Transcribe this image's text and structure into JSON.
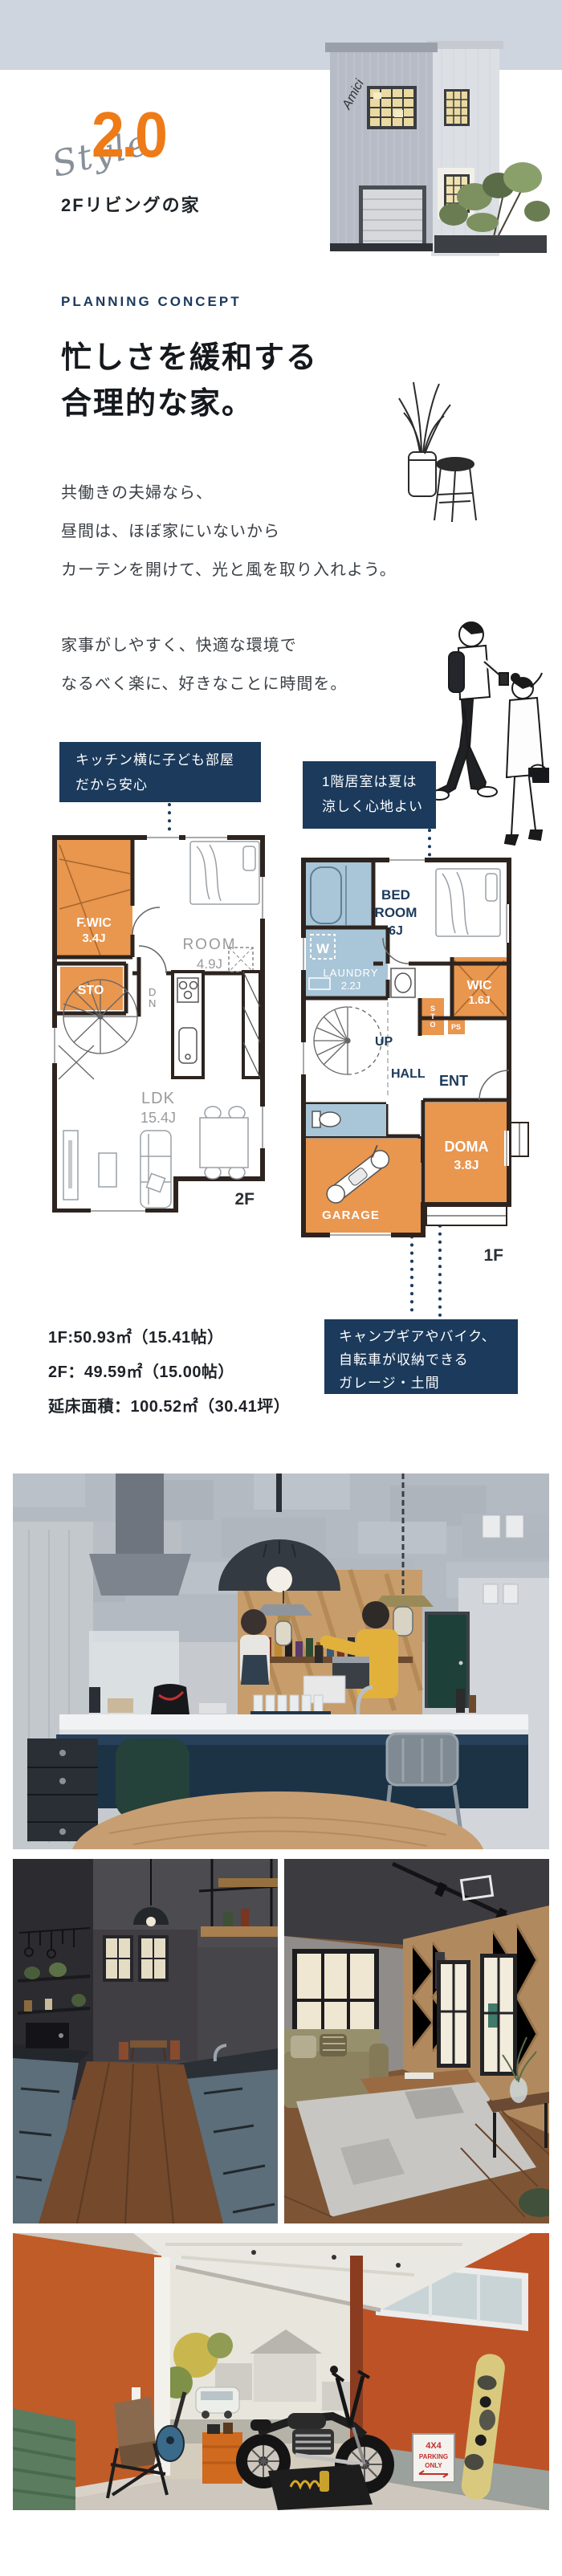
{
  "hero": {
    "style_label": "Style",
    "style_number": "2.0",
    "subtitle": "2Fリビングの家",
    "house_logo": "Amici"
  },
  "concept": {
    "eyebrow": "PLANNING CONCEPT",
    "heading_line1": "忙しさを緩和する",
    "heading_line2": "合理的な家。",
    "paragraph1": [
      "共働きの夫婦なら、",
      "昼間は、ほぼ家にいないから",
      "カーテンを開けて、光と風を取り入れよう。"
    ],
    "paragraph2": [
      "家事がしやすく、快適な環境で",
      "なるべく楽に、好きなことに時間を。"
    ]
  },
  "callouts": {
    "kids_room": {
      "line1": "キッチン横に子ども部屋",
      "line2": "だから安心"
    },
    "first_floor": {
      "line1": "1階居室は夏は",
      "line2": "涼しく心地よい"
    },
    "garage": {
      "line1": "キャンプギアやバイク、",
      "line2": "自転車が収納できる",
      "line3": "ガレージ・土間"
    }
  },
  "floorplan_2f": {
    "floor_label": "2F",
    "fwic": "F.WIC",
    "fwic_size": "3.4J",
    "sto": "STO",
    "room": "ROOM",
    "room_size": "4.9J",
    "dn_stack": [
      "D",
      "N"
    ],
    "ldk": "LDK",
    "ldk_size": "15.4J"
  },
  "floorplan_1f": {
    "floor_label": "1F",
    "bed_line1": "BED",
    "bed_line2": "ROOM",
    "bed_size": "6J",
    "w": "W",
    "laundry": "LAUNDRY",
    "laundry_size": "2.2J",
    "wic": "WIC",
    "wic_size": "1.6J",
    "sto_stack": [
      "S",
      "T",
      "O"
    ],
    "ps": "PS",
    "up": "UP",
    "hall": "HALL",
    "ent": "ENT",
    "doma": "DOMA",
    "doma_size": "3.8J",
    "garage": "GARAGE"
  },
  "areas": {
    "line1": "1F:50.93㎡（15.41帖）",
    "line2": "2F：49.59㎡（15.00帖）",
    "line3": "延床面積：100.52㎡（30.41坪）"
  },
  "photos": {
    "garage_sign_line1": "4X4",
    "garage_sign_line2": "PARKING",
    "garage_sign_line3": "ONLY"
  },
  "colors": {
    "accent_orange": "#ee7b17",
    "navy": "#1b3a5c",
    "plan_orange": "#e9964e",
    "plan_blue": "#a9c6d8",
    "wall": "#2d241f",
    "band": "#cfd5de"
  }
}
